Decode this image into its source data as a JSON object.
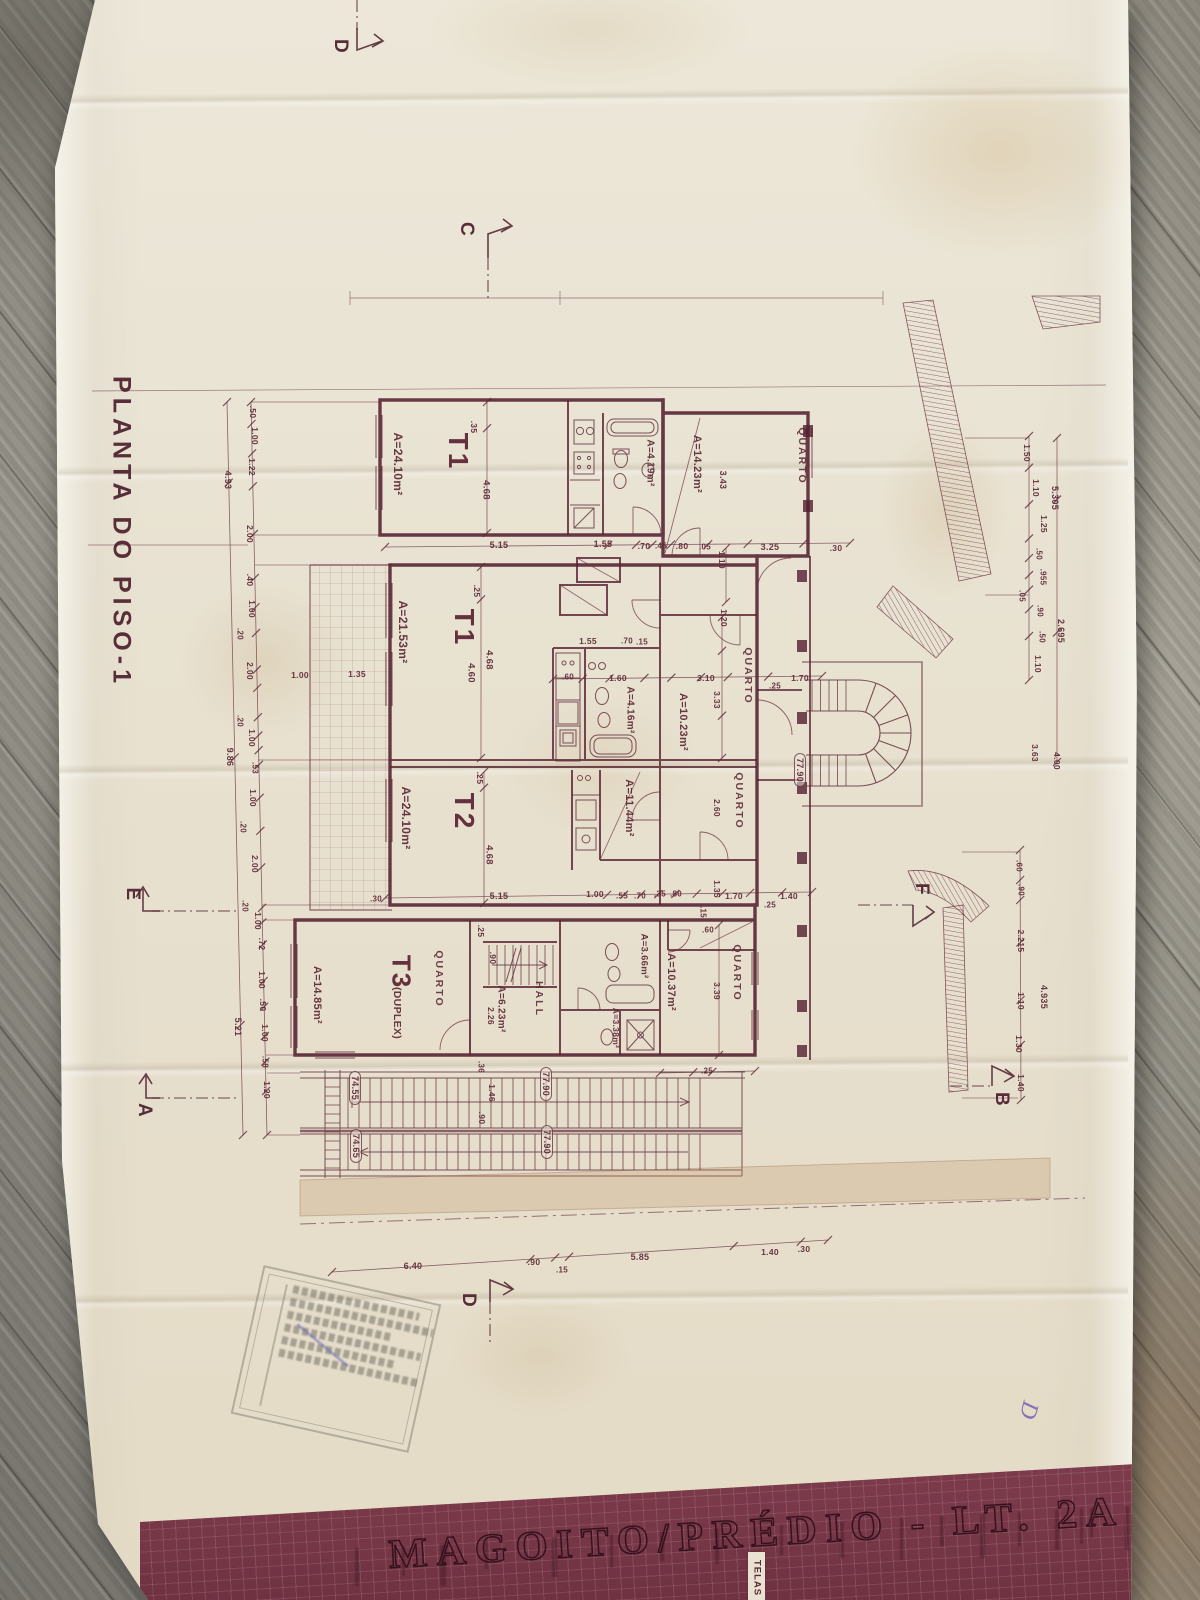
{
  "document": {
    "kind": "photographed architectural drawing on wooden table",
    "plan_title": "PLANTA DO PISO-1",
    "project_banner": "MAGOITO/PRÉDIO - LT. 2A",
    "banner_side_label": "TELAS",
    "handwritten_mark": "D"
  },
  "summary": {
    "units": [
      {
        "unit": "T1",
        "area": "A=24.10m²"
      },
      {
        "unit": "T1",
        "area": "A=21.53m²"
      },
      {
        "unit": "T2",
        "area": "A=24.10m²"
      },
      {
        "unit": "T3 (DUPLEX)",
        "area": "A=14.85m²"
      }
    ],
    "section_markers": [
      "A",
      "B",
      "C",
      "D",
      "E",
      "F"
    ],
    "elevation_marks": [
      "77.90",
      "74.55",
      "74.65"
    ],
    "colors": {
      "ink": "#5d2836",
      "paper": "#e9e3d4",
      "banner": "#7b3b4c",
      "wood": "#8e8c85",
      "stamp_ink": "#6b6b62",
      "pen_ink": "#6d58b5"
    }
  },
  "annotations": [
    {
      "n": "plan-title",
      "t": "PLANTA DO PISO-1",
      "x": 121,
      "y": 532,
      "r": 90,
      "s": 25,
      "c": "title",
      "l": 5
    },
    {
      "n": "section-marker-d-top",
      "t": "D",
      "x": 340,
      "y": 46,
      "r": 90,
      "s": 19,
      "c": "sec"
    },
    {
      "n": "section-marker-c",
      "t": "C",
      "x": 466,
      "y": 229,
      "r": 90,
      "s": 19,
      "c": "sec"
    },
    {
      "n": "section-marker-e",
      "t": "E",
      "x": 132,
      "y": 894,
      "r": 90,
      "s": 19,
      "c": "sec"
    },
    {
      "n": "section-marker-a",
      "t": "A",
      "x": 144,
      "y": 1110,
      "r": 90,
      "s": 19,
      "c": "sec"
    },
    {
      "n": "section-marker-f",
      "t": "F",
      "x": 921,
      "y": 889,
      "r": 90,
      "s": 19,
      "c": "sec"
    },
    {
      "n": "section-marker-b",
      "t": "B",
      "x": 1001,
      "y": 1099,
      "r": 90,
      "s": 19,
      "c": "sec"
    },
    {
      "n": "section-marker-d-bottom",
      "t": "D",
      "x": 468,
      "y": 1300,
      "r": 90,
      "s": 19,
      "c": "sec"
    },
    {
      "n": "unit-label",
      "t": "T1",
      "x": 458,
      "y": 452,
      "r": 90,
      "s": 28,
      "c": "unit",
      "l": 3
    },
    {
      "n": "area-label",
      "t": "A=24.10m²",
      "x": 398,
      "y": 464,
      "r": 90,
      "s": 12
    },
    {
      "n": "area-label",
      "t": "A=4.19m²",
      "x": 650,
      "y": 463,
      "r": 90,
      "s": 10
    },
    {
      "n": "area-label",
      "t": "A=14.23m²",
      "x": 697,
      "y": 464,
      "r": 90,
      "s": 11
    },
    {
      "n": "room-label",
      "t": "QUARTO",
      "x": 802,
      "y": 456,
      "r": 90,
      "s": 10.5,
      "c": "room",
      "l": 2
    },
    {
      "n": "unit-label",
      "t": "T1",
      "x": 464,
      "y": 628,
      "r": 90,
      "s": 28,
      "c": "unit",
      "l": 3
    },
    {
      "n": "area-label",
      "t": "A=21.53m²",
      "x": 403,
      "y": 632,
      "r": 90,
      "s": 12
    },
    {
      "n": "area-label",
      "t": "A=4.16m²",
      "x": 630,
      "y": 710,
      "r": 90,
      "s": 10
    },
    {
      "n": "room-label",
      "t": "QUARTO",
      "x": 748,
      "y": 676,
      "r": 90,
      "s": 10.5,
      "c": "room",
      "l": 2
    },
    {
      "n": "area-label",
      "t": "A=10.23m²",
      "x": 683,
      "y": 722,
      "r": 90,
      "s": 11
    },
    {
      "n": "unit-label",
      "t": "T2",
      "x": 464,
      "y": 812,
      "r": 90,
      "s": 28,
      "c": "unit",
      "l": 3
    },
    {
      "n": "area-label",
      "t": "A=24.10m²",
      "x": 406,
      "y": 818,
      "r": 90,
      "s": 12
    },
    {
      "n": "area-label",
      "t": "A=11.44m²",
      "x": 629,
      "y": 808,
      "r": 90,
      "s": 11
    },
    {
      "n": "room-label",
      "t": "QUARTO",
      "x": 739,
      "y": 801,
      "r": 90,
      "s": 10.5,
      "c": "room",
      "l": 2
    },
    {
      "n": "unit-label",
      "t": "T3",
      "x": 401,
      "y": 972,
      "r": 90,
      "s": 26,
      "c": "unit",
      "l": 2
    },
    {
      "n": "unit-sublabel",
      "t": "(DUPLEX)",
      "x": 397,
      "y": 1013,
      "r": 90,
      "s": 10.5
    },
    {
      "n": "room-label",
      "t": "QUARTO",
      "x": 439,
      "y": 979,
      "r": 90,
      "s": 10.5,
      "c": "room",
      "l": 2
    },
    {
      "n": "area-label",
      "t": "A=14.85m²",
      "x": 317,
      "y": 995,
      "r": 90,
      "s": 11
    },
    {
      "n": "area-label",
      "t": "A=6.23m²",
      "x": 501,
      "y": 1009,
      "r": 90,
      "s": 10
    },
    {
      "n": "dim",
      "t": "2.26",
      "x": 491,
      "y": 1016,
      "r": 90,
      "s": 8.5
    },
    {
      "n": "room-label",
      "t": "HALL",
      "x": 539,
      "y": 999,
      "r": 90,
      "s": 10.5,
      "c": "room",
      "l": 2
    },
    {
      "n": "area-label",
      "t": "A=3.38m²",
      "x": 616,
      "y": 1028,
      "r": 90,
      "s": 8.5
    },
    {
      "n": "area-label",
      "t": "A=3.66m²",
      "x": 644,
      "y": 956,
      "r": 90,
      "s": 9.5
    },
    {
      "n": "area-label",
      "t": "A=10.37m²",
      "x": 671,
      "y": 982,
      "r": 90,
      "s": 11
    },
    {
      "n": "room-label",
      "t": "QUARTO",
      "x": 737,
      "y": 973,
      "r": 90,
      "s": 10.5,
      "c": "room",
      "l": 2
    },
    {
      "n": "dim",
      "t": "3.39",
      "x": 717,
      "y": 991,
      "r": 90,
      "s": 8.5
    },
    {
      "n": "elevation-label",
      "t": "77.90",
      "x": 800,
      "y": 770,
      "r": 90,
      "s": 9,
      "c": "boxed"
    },
    {
      "n": "elevation-label",
      "t": "74.55",
      "x": 355,
      "y": 1088,
      "r": 90,
      "s": 9,
      "c": "boxed"
    },
    {
      "n": "elevation-label",
      "t": "74.65",
      "x": 356,
      "y": 1146,
      "r": 90,
      "s": 9,
      "c": "boxed"
    },
    {
      "n": "elevation-label",
      "t": "77.90",
      "x": 546,
      "y": 1084,
      "r": 90,
      "s": 9,
      "c": "boxed"
    },
    {
      "n": "elevation-label",
      "t": "77.90",
      "x": 547,
      "y": 1142,
      "r": 90,
      "s": 9,
      "c": "boxed"
    },
    {
      "n": "dim",
      "t": ".35",
      "x": 474,
      "y": 427,
      "r": 90,
      "s": 8.5
    },
    {
      "n": "dim",
      "t": "4.68",
      "x": 486,
      "y": 490,
      "r": 90,
      "s": 9.5
    },
    {
      "n": "dim",
      "t": "3.43",
      "x": 723,
      "y": 480,
      "r": 90,
      "s": 9
    },
    {
      "n": "dim",
      "t": "1.10",
      "x": 722,
      "y": 560,
      "r": 90,
      "s": 8.5
    },
    {
      "n": "dim",
      "t": ".25",
      "x": 477,
      "y": 591,
      "r": 90,
      "s": 8.5
    },
    {
      "n": "dim",
      "t": "4.68",
      "x": 489,
      "y": 660,
      "r": 90,
      "s": 9.5
    },
    {
      "n": "dim",
      "t": "4.60",
      "x": 471,
      "y": 673,
      "r": 90,
      "s": 9.5
    },
    {
      "n": "dim",
      "t": "3.33",
      "x": 717,
      "y": 700,
      "r": 90,
      "s": 8.5
    },
    {
      "n": "dim",
      "t": "1.20",
      "x": 724,
      "y": 618,
      "r": 90,
      "s": 8.5
    },
    {
      "n": "dim",
      "t": ".25",
      "x": 480,
      "y": 778,
      "r": 90,
      "s": 8.5
    },
    {
      "n": "dim",
      "t": "4.68",
      "x": 489,
      "y": 855,
      "r": 90,
      "s": 9.5
    },
    {
      "n": "dim",
      "t": "2.60",
      "x": 717,
      "y": 808,
      "r": 90,
      "s": 8.5
    },
    {
      "n": "dim",
      "t": "1.35",
      "x": 717,
      "y": 889,
      "r": 90,
      "s": 8.5
    },
    {
      "n": "dim",
      "t": ".15",
      "x": 703,
      "y": 912,
      "r": 90,
      "s": 8
    },
    {
      "n": "dim",
      "t": ".25",
      "x": 481,
      "y": 931,
      "r": 90,
      "s": 8.5
    },
    {
      "n": "dim",
      "t": ".90",
      "x": 493,
      "y": 958,
      "r": 90,
      "s": 8.5
    },
    {
      "n": "dim",
      "t": ".36",
      "x": 481,
      "y": 1067,
      "r": 90,
      "s": 8
    },
    {
      "n": "dim",
      "t": "1.46",
      "x": 492,
      "y": 1093,
      "r": 90,
      "s": 8.5
    },
    {
      "n": "dim",
      "t": ".90",
      "x": 482,
      "y": 1118,
      "r": 90,
      "s": 8.5
    },
    {
      "n": "dim",
      "t": ".50",
      "x": 253,
      "y": 412,
      "r": 90,
      "s": 8.5
    },
    {
      "n": "dim",
      "t": "1.00",
      "x": 255,
      "y": 436,
      "r": 90,
      "s": 8.5
    },
    {
      "n": "dim",
      "t": "1.22",
      "x": 252,
      "y": 467,
      "r": 90,
      "s": 8.5
    },
    {
      "n": "dim",
      "t": "4.93",
      "x": 228,
      "y": 480,
      "r": 90,
      "s": 9
    },
    {
      "n": "dim",
      "t": "2.00",
      "x": 250,
      "y": 534,
      "r": 90,
      "s": 8.5
    },
    {
      "n": "dim",
      "t": ".40",
      "x": 250,
      "y": 580,
      "r": 90,
      "s": 8.5
    },
    {
      "n": "dim",
      "t": "1.00",
      "x": 252,
      "y": 609,
      "r": 90,
      "s": 8.5
    },
    {
      "n": "dim",
      "t": ".20",
      "x": 240,
      "y": 634,
      "r": 90,
      "s": 8
    },
    {
      "n": "dim",
      "t": "2.00",
      "x": 250,
      "y": 671,
      "r": 90,
      "s": 8.5
    },
    {
      "n": "dim",
      "t": ".20",
      "x": 240,
      "y": 721,
      "r": 90,
      "s": 8
    },
    {
      "n": "dim",
      "t": "1.00",
      "x": 252,
      "y": 738,
      "r": 90,
      "s": 8.5
    },
    {
      "n": "dim",
      "t": "9.86",
      "x": 230,
      "y": 757,
      "r": 90,
      "s": 9
    },
    {
      "n": "dim",
      "t": ".53",
      "x": 255,
      "y": 768,
      "r": 90,
      "s": 8
    },
    {
      "n": "dim",
      "t": "1.00",
      "x": 253,
      "y": 798,
      "r": 90,
      "s": 8.5
    },
    {
      "n": "dim",
      "t": ".20",
      "x": 243,
      "y": 827,
      "r": 90,
      "s": 8
    },
    {
      "n": "dim",
      "t": "2.00",
      "x": 255,
      "y": 864,
      "r": 90,
      "s": 8.5
    },
    {
      "n": "dim",
      "t": ".20",
      "x": 245,
      "y": 906,
      "r": 90,
      "s": 8
    },
    {
      "n": "dim",
      "t": "1.00",
      "x": 258,
      "y": 921,
      "r": 90,
      "s": 8.5
    },
    {
      "n": "dim",
      "t": ".72",
      "x": 262,
      "y": 944,
      "r": 90,
      "s": 8.5
    },
    {
      "n": "dim",
      "t": "1.00",
      "x": 262,
      "y": 980,
      "r": 90,
      "s": 8.5
    },
    {
      "n": "dim",
      "t": ".50",
      "x": 263,
      "y": 1005,
      "r": 90,
      "s": 8.5
    },
    {
      "n": "dim",
      "t": "1.00",
      "x": 265,
      "y": 1033,
      "r": 90,
      "s": 8.5
    },
    {
      "n": "dim",
      "t": ".58",
      "x": 265,
      "y": 1062,
      "r": 90,
      "s": 8
    },
    {
      "n": "dim",
      "t": "5.21",
      "x": 238,
      "y": 1027,
      "r": 90,
      "s": 9
    },
    {
      "n": "dim",
      "t": "1.20",
      "x": 267,
      "y": 1090,
      "r": 90,
      "s": 8.5
    },
    {
      "n": "dim",
      "t": "1.50",
      "x": 1027,
      "y": 453,
      "r": 90,
      "s": 8.5
    },
    {
      "n": "dim",
      "t": "1.10",
      "x": 1036,
      "y": 488,
      "r": 90,
      "s": 8.5
    },
    {
      "n": "dim",
      "t": "1.25",
      "x": 1044,
      "y": 524,
      "r": 90,
      "s": 8.5
    },
    {
      "n": "dim",
      "t": ".50",
      "x": 1039,
      "y": 554,
      "r": 90,
      "s": 8
    },
    {
      "n": "dim",
      "t": ".955",
      "x": 1043,
      "y": 577,
      "r": 90,
      "s": 8
    },
    {
      "n": "dim",
      "t": ".05",
      "x": 1022,
      "y": 596,
      "r": 90,
      "s": 8
    },
    {
      "n": "dim",
      "t": ".90",
      "x": 1040,
      "y": 611,
      "r": 90,
      "s": 8
    },
    {
      "n": "dim",
      "t": ".50",
      "x": 1042,
      "y": 637,
      "r": 90,
      "s": 8
    },
    {
      "n": "dim",
      "t": "1.10",
      "x": 1038,
      "y": 664,
      "r": 90,
      "s": 8.5
    },
    {
      "n": "dim",
      "t": "5.305",
      "x": 1055,
      "y": 498,
      "r": 90,
      "s": 9
    },
    {
      "n": "dim",
      "t": "2.695",
      "x": 1061,
      "y": 631,
      "r": 90,
      "s": 9
    },
    {
      "n": "dim",
      "t": "3.63",
      "x": 1035,
      "y": 753,
      "r": 90,
      "s": 8.5
    },
    {
      "n": "dim",
      "t": "4.00",
      "x": 1057,
      "y": 761,
      "r": 90,
      "s": 8.5
    },
    {
      "n": "dim",
      "t": ".60",
      "x": 1019,
      "y": 866,
      "r": 90,
      "s": 8
    },
    {
      "n": "dim",
      "t": ".90",
      "x": 1021,
      "y": 890,
      "r": 90,
      "s": 8
    },
    {
      "n": "dim",
      "t": "2.215",
      "x": 1021,
      "y": 941,
      "r": 90,
      "s": 8.5
    },
    {
      "n": "dim",
      "t": "1.10",
      "x": 1021,
      "y": 1001,
      "r": 90,
      "s": 8.5
    },
    {
      "n": "dim",
      "t": "1.30",
      "x": 1019,
      "y": 1044,
      "r": 90,
      "s": 8.5
    },
    {
      "n": "dim",
      "t": "1.40",
      "x": 1021,
      "y": 1083,
      "r": 90,
      "s": 8.5
    },
    {
      "n": "dim",
      "t": "4.935",
      "x": 1044,
      "y": 997,
      "r": 90,
      "s": 9
    },
    {
      "n": "dim",
      "t": "5.15",
      "x": 499,
      "y": 545,
      "r": 0,
      "s": 9
    },
    {
      "n": "dim",
      "t": "1.55",
      "x": 603,
      "y": 544,
      "r": 0,
      "s": 9
    },
    {
      "n": "dim",
      "t": ".70",
      "x": 644,
      "y": 546,
      "r": 0,
      "s": 8.5
    },
    {
      "n": "dim",
      "t": ".45",
      "x": 661,
      "y": 546,
      "r": 0,
      "s": 8
    },
    {
      "n": "dim",
      "t": ".80",
      "x": 682,
      "y": 546,
      "r": 0,
      "s": 8.5
    },
    {
      "n": "dim",
      "t": ".05",
      "x": 705,
      "y": 547,
      "r": 0,
      "s": 8
    },
    {
      "n": "dim",
      "t": "3.25",
      "x": 770,
      "y": 547,
      "r": 0,
      "s": 9
    },
    {
      "n": "dim",
      "t": ".30",
      "x": 836,
      "y": 548,
      "r": 0,
      "s": 8.5
    },
    {
      "n": "dim",
      "t": "1.55",
      "x": 588,
      "y": 641,
      "r": 0,
      "s": 8.5
    },
    {
      "n": "dim",
      "t": ".70",
      "x": 627,
      "y": 641,
      "r": 0,
      "s": 8
    },
    {
      "n": "dim",
      "t": ".15",
      "x": 642,
      "y": 642,
      "r": 0,
      "s": 8
    },
    {
      "n": "dim",
      "t": ".60",
      "x": 568,
      "y": 677,
      "r": 0,
      "s": 8
    },
    {
      "n": "dim",
      "t": "1.60",
      "x": 618,
      "y": 678,
      "r": 0,
      "s": 8.5
    },
    {
      "n": "dim",
      "t": "3.10",
      "x": 706,
      "y": 678,
      "r": 0,
      "s": 8.5
    },
    {
      "n": "dim",
      "t": "1.70",
      "x": 800,
      "y": 678,
      "r": 0,
      "s": 8.5
    },
    {
      "n": "dim",
      "t": ".25",
      "x": 775,
      "y": 686,
      "r": 0,
      "s": 8
    },
    {
      "n": "dim",
      "t": "1.00",
      "x": 300,
      "y": 675,
      "r": 0,
      "s": 8.5
    },
    {
      "n": "dim",
      "t": "1.35",
      "x": 357,
      "y": 674,
      "r": 0,
      "s": 8.5
    },
    {
      "n": "dim",
      "t": "5.15",
      "x": 499,
      "y": 896,
      "r": 0,
      "s": 9
    },
    {
      "n": "dim",
      "t": "1.00",
      "x": 595,
      "y": 894,
      "r": 0,
      "s": 8.5
    },
    {
      "n": "dim",
      "t": ".55",
      "x": 622,
      "y": 896,
      "r": 0,
      "s": 8
    },
    {
      "n": "dim",
      "t": ".70",
      "x": 640,
      "y": 896,
      "r": 0,
      "s": 8
    },
    {
      "n": "dim",
      "t": ".35",
      "x": 660,
      "y": 894,
      "r": 0,
      "s": 8
    },
    {
      "n": "dim",
      "t": ".80",
      "x": 676,
      "y": 894,
      "r": 0,
      "s": 8
    },
    {
      "n": "dim",
      "t": "1.70",
      "x": 734,
      "y": 896,
      "r": 0,
      "s": 8.5
    },
    {
      "n": "dim",
      "t": "1.40",
      "x": 789,
      "y": 896,
      "r": 0,
      "s": 8.5
    },
    {
      "n": "dim",
      "t": ".25",
      "x": 770,
      "y": 905,
      "r": 0,
      "s": 8
    },
    {
      "n": "dim",
      "t": ".60",
      "x": 708,
      "y": 930,
      "r": 0,
      "s": 8
    },
    {
      "n": "dim",
      "t": ".30",
      "x": 376,
      "y": 899,
      "r": 0,
      "s": 8
    },
    {
      "n": "dim",
      "t": ".25",
      "x": 707,
      "y": 1071,
      "r": 0,
      "s": 8
    },
    {
      "n": "dim",
      "t": "6.40",
      "x": 413,
      "y": 1266,
      "r": 0,
      "s": 9
    },
    {
      "n": "dim",
      "t": ".90",
      "x": 534,
      "y": 1262,
      "r": 0,
      "s": 8.5
    },
    {
      "n": "dim",
      "t": ".15",
      "x": 562,
      "y": 1270,
      "r": 0,
      "s": 8
    },
    {
      "n": "dim",
      "t": "5.85",
      "x": 640,
      "y": 1257,
      "r": 0,
      "s": 9
    },
    {
      "n": "dim",
      "t": "1.40",
      "x": 770,
      "y": 1252,
      "r": 0,
      "s": 8.5
    },
    {
      "n": "dim",
      "t": ".30",
      "x": 804,
      "y": 1249,
      "r": 0,
      "s": 8.5
    },
    {
      "n": "handwritten-mark",
      "t": "D",
      "x": 1028,
      "y": 1410,
      "r": 105,
      "s": 24,
      "c": "pen"
    }
  ]
}
